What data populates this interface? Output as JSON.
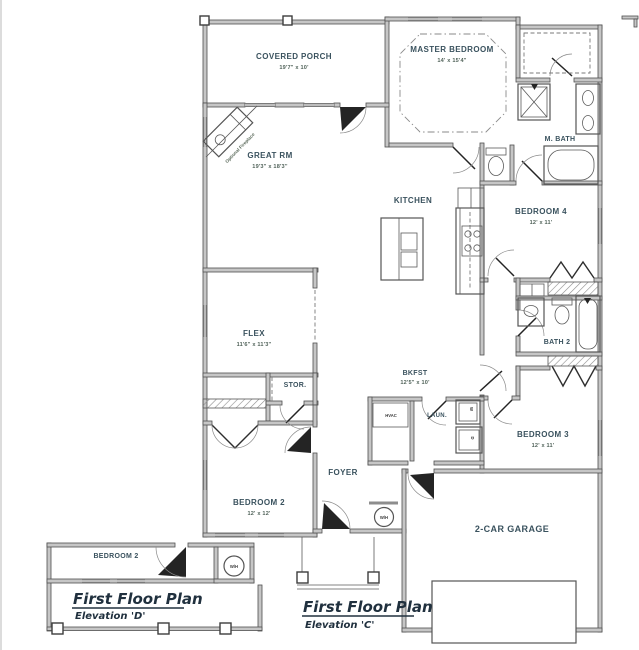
{
  "plan": {
    "rooms": {
      "covered_porch": {
        "name": "COVERED PORCH",
        "dims": "19'7\" x 10'"
      },
      "master_bedroom": {
        "name": "MASTER BEDROOM",
        "dims": "14' x 15'4\""
      },
      "master_bath": {
        "name": "M. BATH"
      },
      "great_rm": {
        "name": "GREAT RM",
        "dims": "19'3\" x 18'3\""
      },
      "kitchen": {
        "name": "KITCHEN"
      },
      "bedroom4": {
        "name": "BEDROOM 4",
        "dims": "12' x 11'"
      },
      "flex": {
        "name": "FLEX",
        "dims": "11'6\" x 11'3\""
      },
      "stor": {
        "name": "STOR."
      },
      "bkfst": {
        "name": "BKFST",
        "dims": "12'5\" x 10'"
      },
      "hvac": {
        "name": "HVAC"
      },
      "laundry": {
        "name": "LAUN."
      },
      "bath2": {
        "name": "BATH 2"
      },
      "bedroom3": {
        "name": "BEDROOM 3",
        "dims": "12' x 11'"
      },
      "foyer": {
        "name": "FOYER"
      },
      "bedroom2": {
        "name": "BEDROOM 2",
        "dims": "12' x 12'"
      },
      "garage": {
        "name": "2-CAR GARAGE"
      },
      "bedroom2_alt": {
        "name": "BEDROOM 2"
      }
    },
    "annotations": {
      "optional_fireplace": "Optional Fireplace",
      "water_heater": "W/H",
      "washer": "W",
      "dryer": "D"
    },
    "captions": {
      "left": {
        "title": "First Floor Plan",
        "subtitle": "Elevation 'D'"
      },
      "center": {
        "title": "First Floor Plan",
        "subtitle": "Elevation 'C'"
      }
    },
    "colors": {
      "wall_fill": "#c6c6c6",
      "wall_stroke": "#4f4f4f",
      "label": "#3a525e",
      "dims": "#51635a",
      "caption": "#20303e"
    }
  }
}
